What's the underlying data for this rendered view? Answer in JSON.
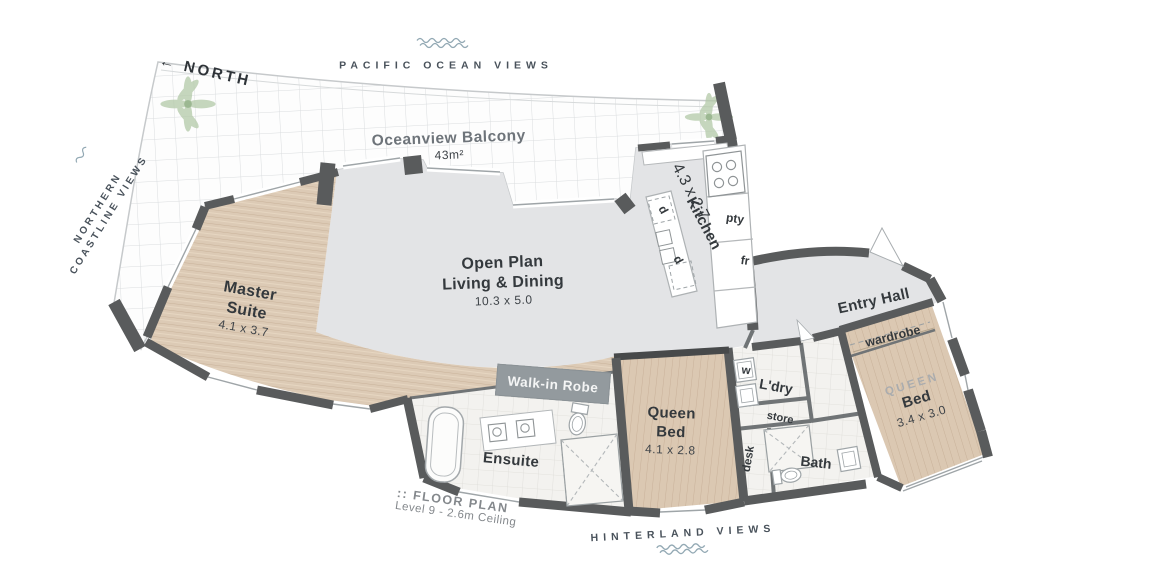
{
  "compass": {
    "arrow": "←",
    "label": "NORTH"
  },
  "views": {
    "top": "PACIFIC OCEAN VIEWS",
    "left_line1": "NORTHERN",
    "left_line2": "COASTLINE VIEWS",
    "bottom": "HINTERLAND VIEWS"
  },
  "rooms": {
    "balcony": {
      "name": "Oceanview Balcony",
      "dims": "43m²"
    },
    "living": {
      "line1": "Open Plan",
      "line2": "Living & Dining",
      "dims": "10.3 x 5.0"
    },
    "kitchen": {
      "name": "Kitchen",
      "dims": "4.3 x 2.7",
      "labels": {
        "d1": "d",
        "d2": "d",
        "pantry": "pty",
        "fridge": "fr"
      }
    },
    "master": {
      "line1": "Master",
      "line2": "Suite",
      "dims": "4.1 x 3.7"
    },
    "entry": {
      "name": "Entry Hall"
    },
    "wardrobe": {
      "name": "wardrobe"
    },
    "queen_right": {
      "tag": "QUEEN",
      "name": "Bed",
      "dims": "3.4 x 3.0"
    },
    "walk_in_robe": {
      "name": "Walk-in Robe"
    },
    "ensuite": {
      "name": "Ensuite"
    },
    "queen_mid": {
      "line1": "Queen",
      "line2": "Bed",
      "dims": "4.1 x 2.8"
    },
    "laundry": {
      "name": "L'dry",
      "washer": "w",
      "store": "store",
      "desk": "desk"
    },
    "bath": {
      "name": "Bath"
    }
  },
  "caption": {
    "line1": ":: FLOOR PLAN",
    "line2": "Level 9 - 2.6m Ceiling"
  },
  "colors": {
    "wall": "#595b5c",
    "wood": "#dccab5",
    "floor_gray": "#e3e4e6",
    "robe_gray": "#939a9e",
    "tile": "#f3f2ef",
    "wave": "#93a9b4",
    "palm": "#b3c9a8",
    "text_dark": "#34393d",
    "text_muted": "#6e747a"
  }
}
